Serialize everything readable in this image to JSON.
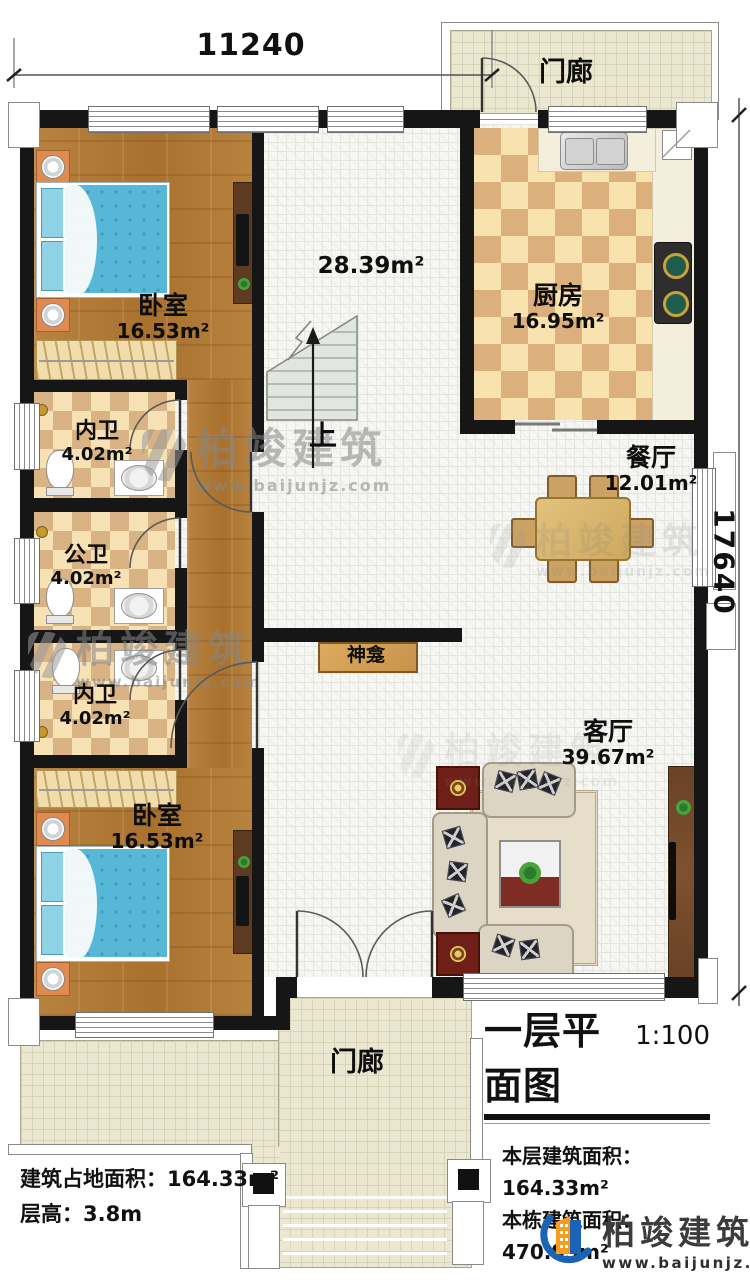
{
  "dimensions": {
    "width_label": "11240",
    "height_label": "17640"
  },
  "rooms": {
    "porch_top": {
      "name": "门廊"
    },
    "kitchen": {
      "name": "厨房",
      "area": "16.95m²"
    },
    "dining": {
      "name": "餐厅",
      "area": "12.01m²"
    },
    "bedroom_top": {
      "name": "卧室",
      "area": "16.53m²"
    },
    "bath_inner_1": {
      "name": "内卫",
      "area": "4.02m²"
    },
    "bath_public": {
      "name": "公卫",
      "area": "4.02m²"
    },
    "bath_inner_2": {
      "name": "内卫",
      "area": "4.02m²"
    },
    "bedroom_bottom": {
      "name": "卧室",
      "area": "16.53m²"
    },
    "living": {
      "name": "客厅",
      "area": "39.67m²"
    },
    "hallway": {
      "area": "28.39m²"
    },
    "shrine": {
      "name": "神龛"
    },
    "porch_bottom": {
      "name": "门廊"
    }
  },
  "stairs": {
    "up_label": "上"
  },
  "title_block": {
    "title": "一层平面图",
    "scale": "1:100",
    "rows": [
      {
        "label": "本层建筑面积：",
        "value": "164.33m²"
      },
      {
        "label": "本栋建筑面积：",
        "value": "470.95m²"
      }
    ]
  },
  "site_info": {
    "rows": [
      {
        "label": "建筑占地面积：",
        "value": "164.33m²"
      },
      {
        "label": "层高：",
        "value": "3.8m"
      }
    ]
  },
  "brand": {
    "name": "柏竣建筑",
    "website": "www.baijunjz.com"
  },
  "watermark": {
    "name": "柏竣建筑",
    "website": "www.baijunjz.com"
  }
}
